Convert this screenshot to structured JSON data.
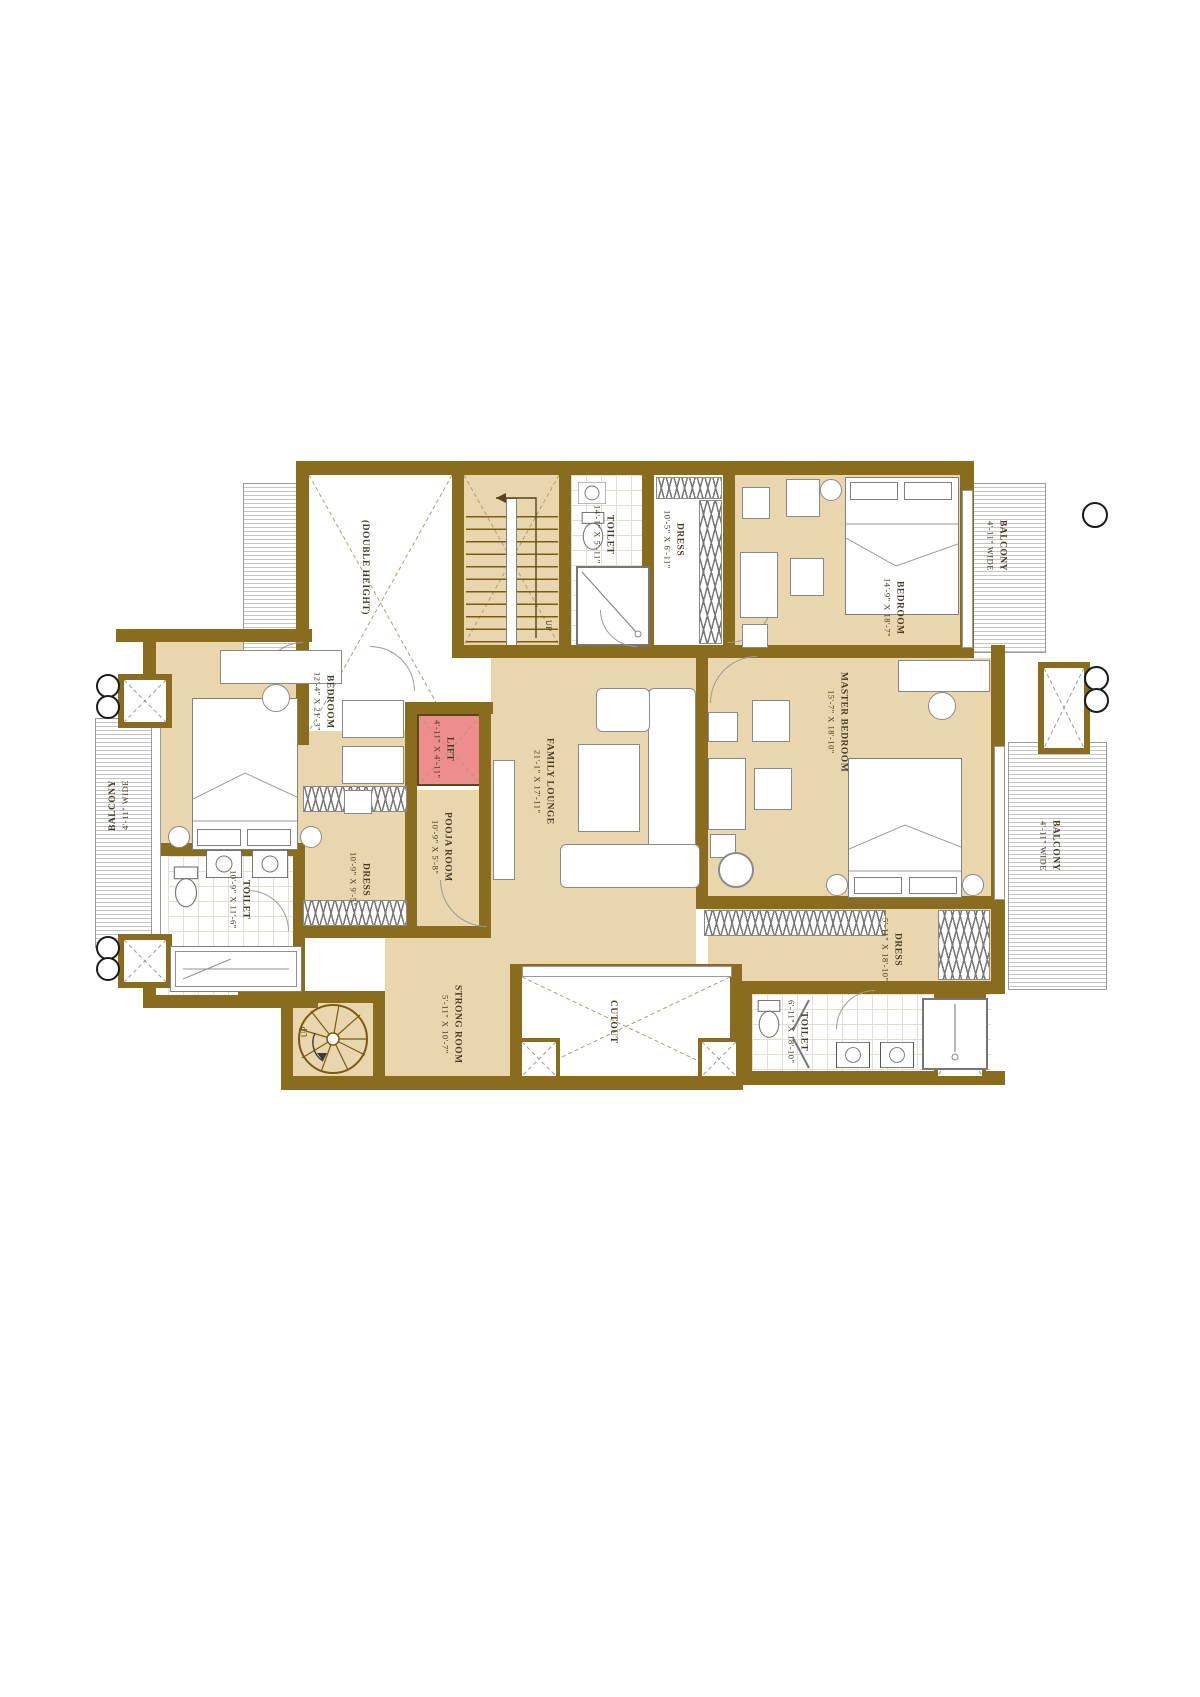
{
  "colors": {
    "wall": "#8a6c1e",
    "floor": "#e9d6ae",
    "lift": "#ee8d8d",
    "hatch_line": "#c3c3c3"
  },
  "rooms": {
    "double_height": {
      "name": "(DOUBLE HEIGHT)"
    },
    "stair": {
      "up": "UP"
    },
    "toilet_top": {
      "name": "TOILET",
      "dims": "14'-1\" X 5'-11\""
    },
    "dress_top": {
      "name": "DRESS",
      "dims": "10'-5\" X 6'-11\""
    },
    "bedroom_top_right": {
      "name": "BEDROOM",
      "dims": "14'-9\" X 18'-7\""
    },
    "balcony_top_right": {
      "name": "BALCONY",
      "dims": "4'-11\" WIDE"
    },
    "balcony_left": {
      "name": "BALCONY",
      "dims": "4'-11\" WIDE"
    },
    "bedroom_left": {
      "name": "BEDROOM",
      "dims": "12'-4\" X 21'-3\""
    },
    "toilet_left": {
      "name": "TOILET",
      "dims": "10'-9\" X 11'-6\""
    },
    "dress_left": {
      "name": "DRESS",
      "dims": "10'-9\" X 9'-5\""
    },
    "lift": {
      "name": "LIFT",
      "dims": "4'-11\" X 4'-11\""
    },
    "pooja_room": {
      "name": "POOJA ROOM",
      "dims": "10'-9\" X 5'-8\""
    },
    "family_lounge": {
      "name": "FAMILY LOUNGE",
      "dims": "21'-1\" X 17'-11\""
    },
    "master_bedroom": {
      "name": "MASTER BEDROOM",
      "dims": "15'-7\" X 18'-10\""
    },
    "balcony_right": {
      "name": "BALCONY",
      "dims": "4'-11\" WIDE"
    },
    "dress_right": {
      "name": "DRESS",
      "dims": "5'-11\" X 18'-10\""
    },
    "toilet_right": {
      "name": "TOILET",
      "dims": "6'-11\" X 18'-10\""
    },
    "strong_room": {
      "name": "STRONG ROOM",
      "dims": "5'-11\" X 10'-7\""
    },
    "cutout": {
      "name": "CUTOUT"
    },
    "spiral_stair": {
      "up": "UP"
    }
  }
}
